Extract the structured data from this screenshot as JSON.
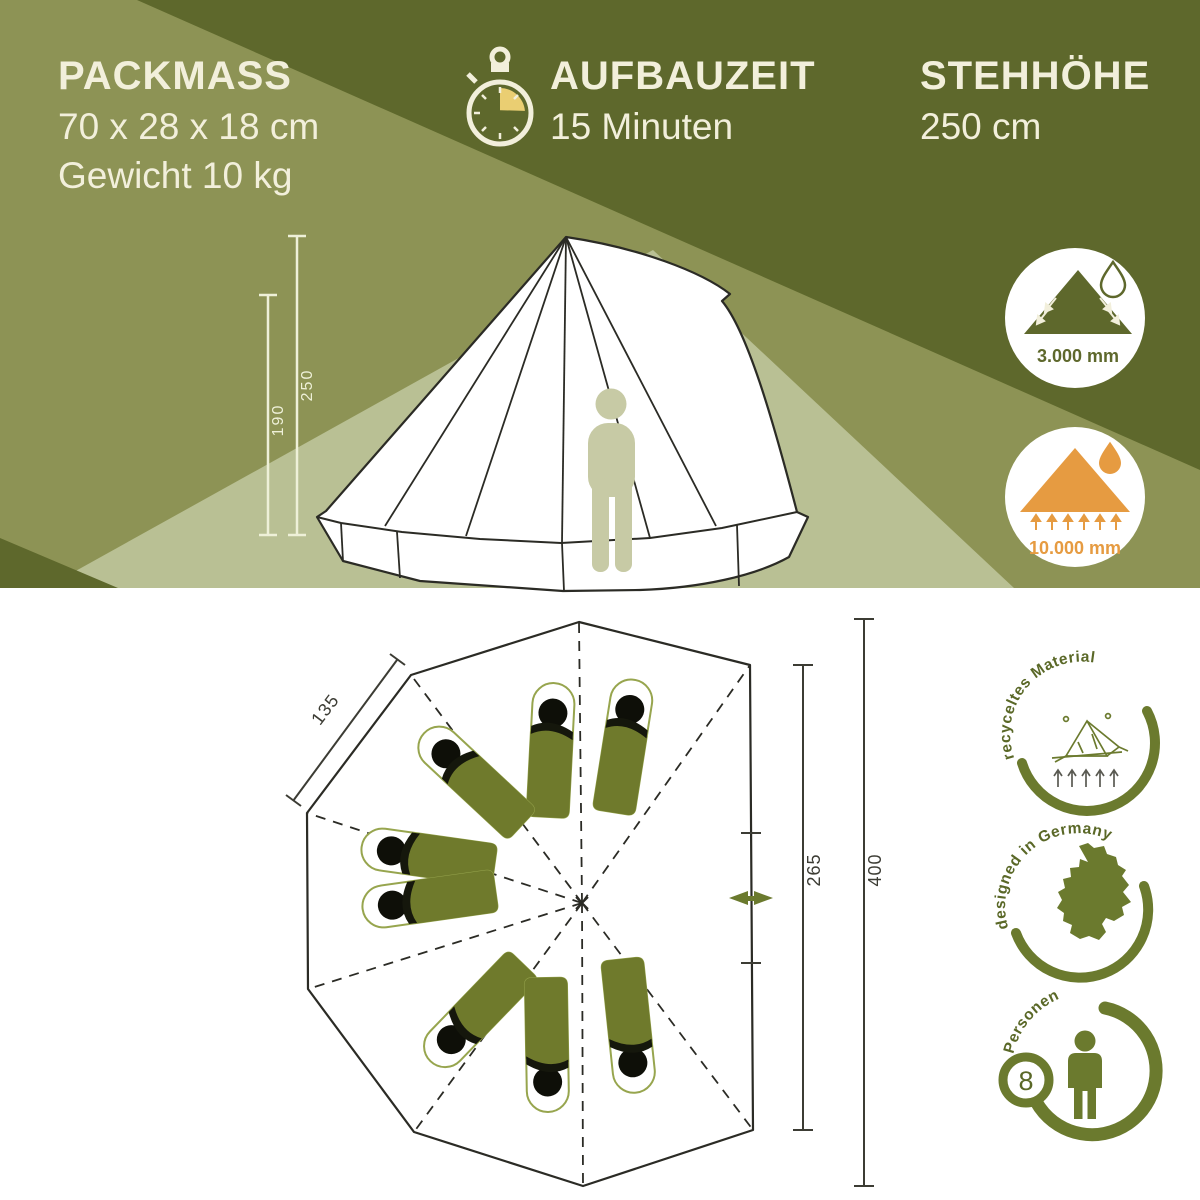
{
  "header": {
    "packmass": {
      "title": "PACKMASS",
      "size": "70 x 28 x 18 cm",
      "weight": "Gewicht 10 kg"
    },
    "aufbauzeit": {
      "title": "AUFBAUZEIT",
      "value": "15 Minuten",
      "icon": "stopwatch-icon"
    },
    "stehhoehe": {
      "title": "STEHHÖHE",
      "value": "250 cm"
    }
  },
  "side_view": {
    "total_height_cm": "250",
    "wall_height_cm": "190",
    "icon": "bell-tent-side-view"
  },
  "waterproof_badges": {
    "flysheet": {
      "value": "3.000 mm",
      "icon": "tent-rain-runoff-icon"
    },
    "groundsheet": {
      "value": "10.000 mm",
      "icon": "groundsheet-water-icon"
    }
  },
  "floor_plan": {
    "icon": "tent-floor-plan",
    "side_length_cm": "135",
    "door_wall_cm": "265",
    "length_cm": "400",
    "sleeping_bag_count": 8,
    "door_icon": "door-arrow-icon"
  },
  "feature_badges": {
    "recycled": {
      "label": "recyceltes Material",
      "icon": "tent-line-icon"
    },
    "designed": {
      "label": "designed in Germany",
      "icon": "germany-map-icon"
    },
    "persons": {
      "label": "Personen",
      "count": "8",
      "icon": "person-icon"
    }
  },
  "colors": {
    "olive_dark": "#5e682c",
    "olive_mid": "#8d9355",
    "sage_beam": "#b9c094",
    "cream": "#f2efdb",
    "icon_green": "#6b7a2e",
    "orange": "#e69b41",
    "gold": "#eace72",
    "bag_green": "#6f7a2c"
  }
}
